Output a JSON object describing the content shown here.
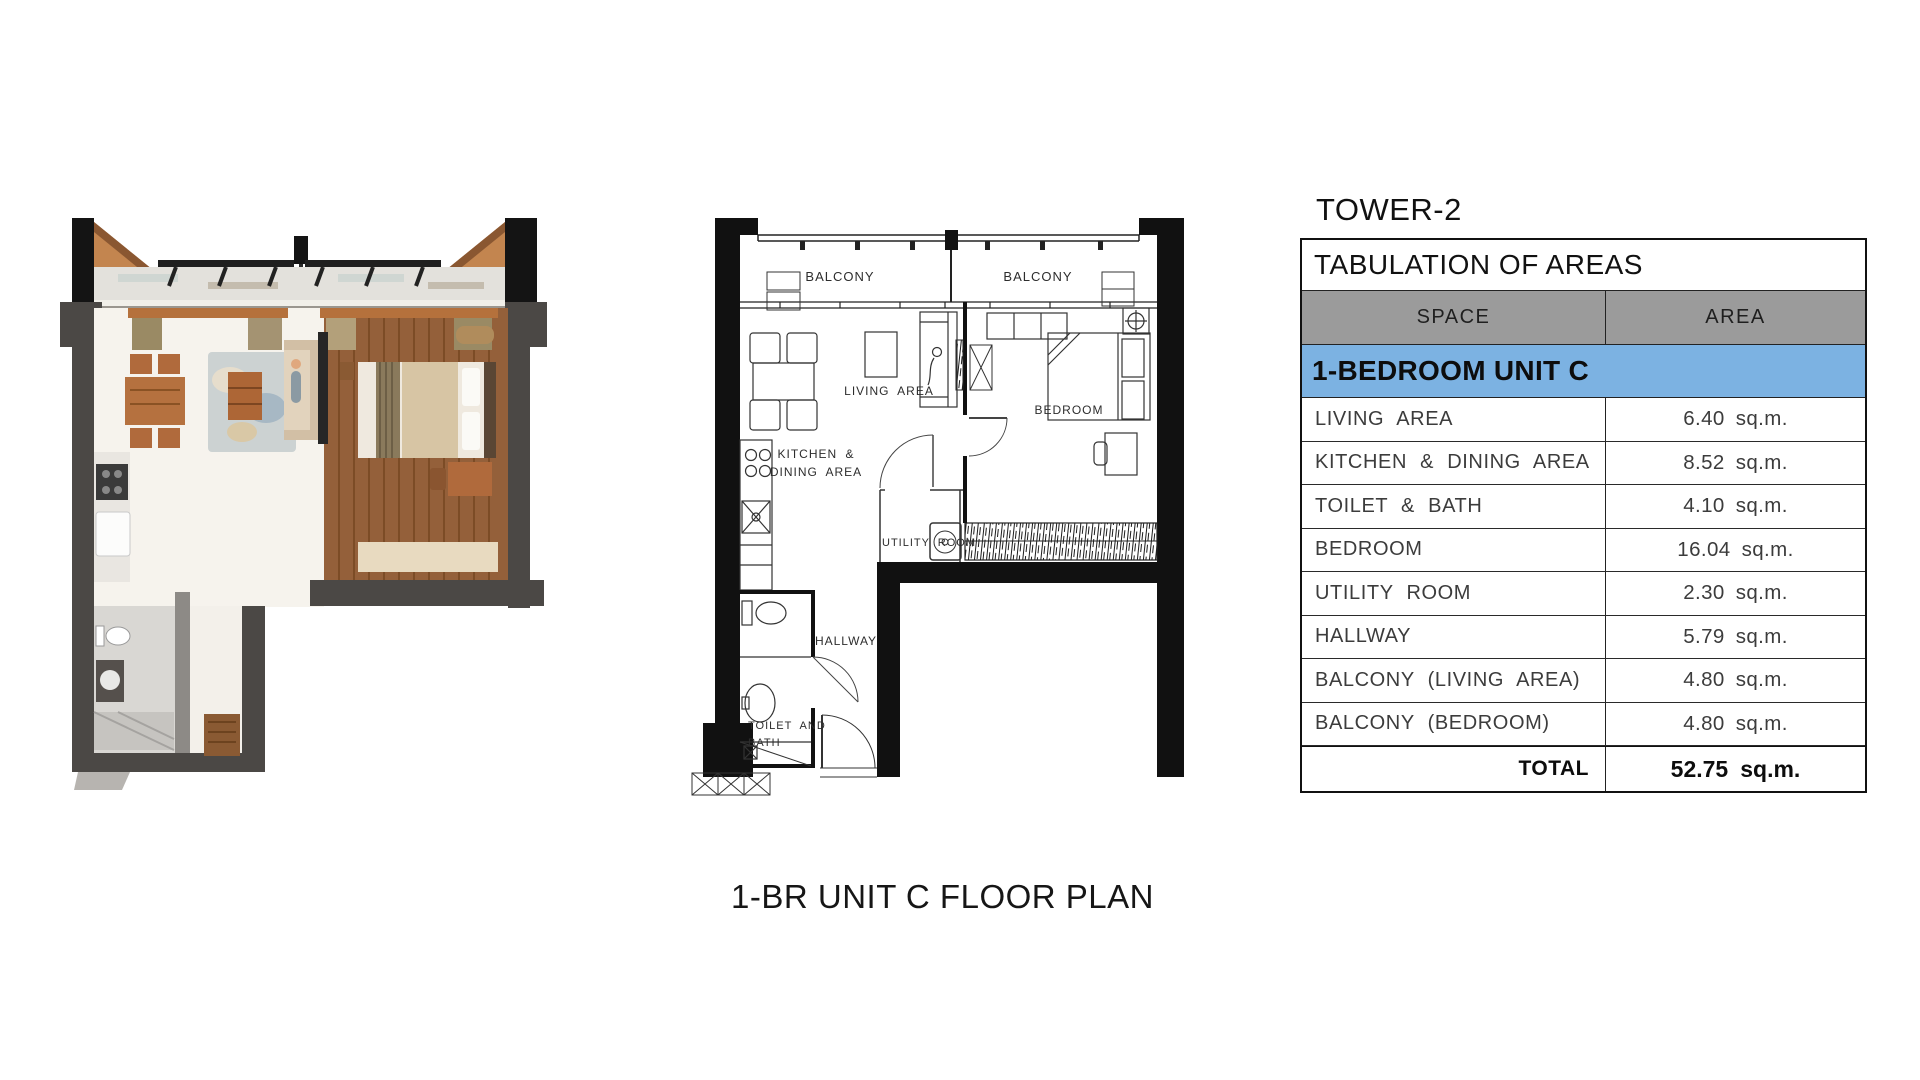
{
  "header": {
    "tower": "TOWER-2"
  },
  "table": {
    "title": "TABULATION OF AREAS",
    "columns": {
      "space": "SPACE",
      "area": "AREA"
    },
    "section": "1-BEDROOM UNIT C",
    "rows": [
      {
        "space": "LIVING AREA",
        "area": "6.40",
        "unit": "sq.m."
      },
      {
        "space": "KITCHEN & DINING AREA",
        "area": "8.52",
        "unit": "sq.m."
      },
      {
        "space": "TOILET & BATH",
        "area": "4.10",
        "unit": "sq.m."
      },
      {
        "space": "BEDROOM",
        "area": "16.04",
        "unit": "sq.m."
      },
      {
        "space": "UTILITY ROOM",
        "area": "2.30",
        "unit": "sq.m."
      },
      {
        "space": "HALLWAY",
        "area": "5.79",
        "unit": "sq.m."
      },
      {
        "space": "BALCONY (LIVING AREA)",
        "area": "4.80",
        "unit": "sq.m."
      },
      {
        "space": "BALCONY (BEDROOM)",
        "area": "4.80",
        "unit": "sq.m."
      }
    ],
    "total": {
      "label": "TOTAL",
      "area": "52.75",
      "unit": "sq.m."
    }
  },
  "floorplan": {
    "caption": "1-BR UNIT C FLOOR PLAN",
    "labels": {
      "balcony_left": "BALCONY",
      "balcony_right": "BALCONY",
      "living": "LIVING AREA",
      "bedroom": "BEDROOM",
      "kitchen_line1": "KITCHEN &",
      "kitchen_line2": "DINING AREA",
      "utility": "UTILITY ROOM",
      "hallway": "HALLWAY",
      "toilet_line1": "TOILET AND",
      "toilet_line2": "BATH"
    }
  },
  "colors": {
    "table_header_bg": "#9b9b9b",
    "table_section_bg": "#7cb2e2",
    "wall_black": "#111111",
    "render_wall_gray": "#4b4845",
    "render_wood_floor": "#94603a",
    "render_terracotta": "#c3854f"
  }
}
